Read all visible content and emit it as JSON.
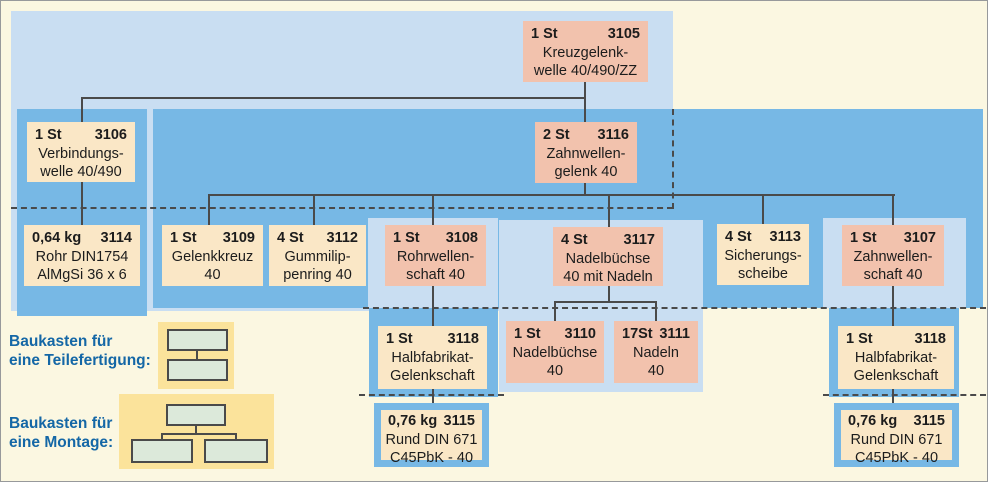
{
  "figure": {
    "type": "bill-of-materials-tree",
    "language": "de"
  },
  "colors": {
    "page_background": "#FBF7E1",
    "light_blue_panel": "#C9DEF2",
    "medium_blue_panel": "#77B8E5",
    "salmon_box": "#F2C2AD",
    "cream_box": "#FAE7C6",
    "legend_yellow": "#FBE39B",
    "legend_green": "#DCE9DA",
    "legend_text_blue": "#1467A6",
    "connector_line": "#4a4a4a"
  },
  "nodes": {
    "n3105": {
      "qty": "1 St",
      "code": "3105",
      "line1": "Kreuzgelenk-",
      "line2": "welle 40/490/ZZ"
    },
    "n3106": {
      "qty": "1 St",
      "code": "3106",
      "line1": "Verbindungs-",
      "line2": "welle 40/490"
    },
    "n3116": {
      "qty": "2 St",
      "code": "3116",
      "line1": "Zahnwellen-",
      "line2": "gelenk 40"
    },
    "n3114": {
      "qty": "0,64 kg",
      "code": "3114",
      "line1": "Rohr DIN1754",
      "line2": "AlMgSi 36 x 6"
    },
    "n3109": {
      "qty": "1 St",
      "code": "3109",
      "line1": "Gelenkkreuz",
      "line2": "40"
    },
    "n3112": {
      "qty": "4 St",
      "code": "3112",
      "line1": "Gummilip-",
      "line2": "penring 40"
    },
    "n3108": {
      "qty": "1 St",
      "code": "3108",
      "line1": "Rohrwellen-",
      "line2": "schaft 40"
    },
    "n3117": {
      "qty": "4 St",
      "code": "3117",
      "line1": "Nadelbüchse",
      "line2": "40 mit Nadeln"
    },
    "n3113": {
      "qty": "4 St",
      "code": "3113",
      "line1": "Sicherungs-",
      "line2": "scheibe"
    },
    "n3107": {
      "qty": "1 St",
      "code": "3107",
      "line1": "Zahnwellen-",
      "line2": "schaft 40"
    },
    "n3118L": {
      "qty": "1 St",
      "code": "3118",
      "line1": "Halbfabrikat-",
      "line2": "Gelenkschaft"
    },
    "n3110": {
      "qty": "1 St",
      "code": "3110",
      "line1": "Nadelbüchse",
      "line2": "40"
    },
    "n3111": {
      "qty": "17St",
      "code": "3111",
      "line1": "Nadeln",
      "line2": "40"
    },
    "n3118R": {
      "qty": "1 St",
      "code": "3118",
      "line1": "Halbfabrikat-",
      "line2": "Gelenkschaft"
    },
    "n3115L": {
      "qty": "0,76 kg",
      "code": "3115",
      "line1": "Rund DIN 671",
      "line2": "C45PbK - 40"
    },
    "n3115R": {
      "qty": "0,76 kg",
      "code": "3115",
      "line1": "Rund DIN 671",
      "line2": "C45PbK - 40"
    }
  },
  "legend": {
    "teilefertigung": {
      "line1": "Baukasten für",
      "line2": "eine Teilefertigung:"
    },
    "montage": {
      "line1": "Baukasten für",
      "line2": "eine Montage:"
    }
  }
}
